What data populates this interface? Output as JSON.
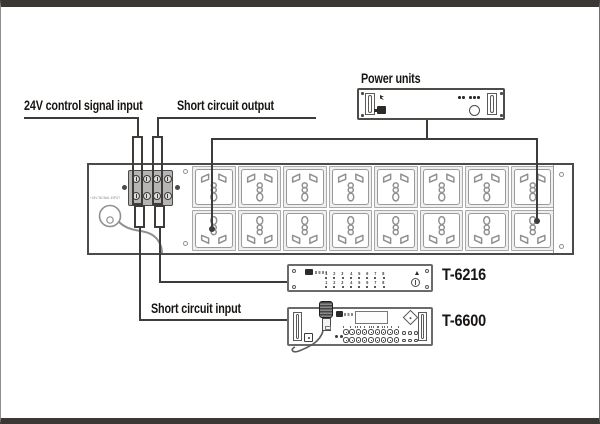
{
  "frame": {
    "border_color": "#3b3733"
  },
  "labels": {
    "control_input": "24V control signal input",
    "short_output": "Short circuit output",
    "power_units": "Power units",
    "short_input": "Short circuit input",
    "t6216": "T-6216",
    "t6600": "T-6600"
  },
  "strip": {
    "socket_columns": 8,
    "socket_rows": 2,
    "terminal_columns": 4,
    "terminal_rows": 2,
    "panel_print": "+24V SIGNAL INPUT"
  },
  "t6216_panel": {
    "channels": [
      "1",
      "2",
      "3",
      "4",
      "5",
      "6",
      "7",
      "8"
    ],
    "channel_rows": 2
  },
  "t6600_panel": {
    "knob_rows": 2,
    "knobs_per_row": 9,
    "aux_rows": 2,
    "aux_per_row": 3,
    "lcd_ticks": 8
  },
  "power_unit": {
    "vent_dots": 5
  }
}
